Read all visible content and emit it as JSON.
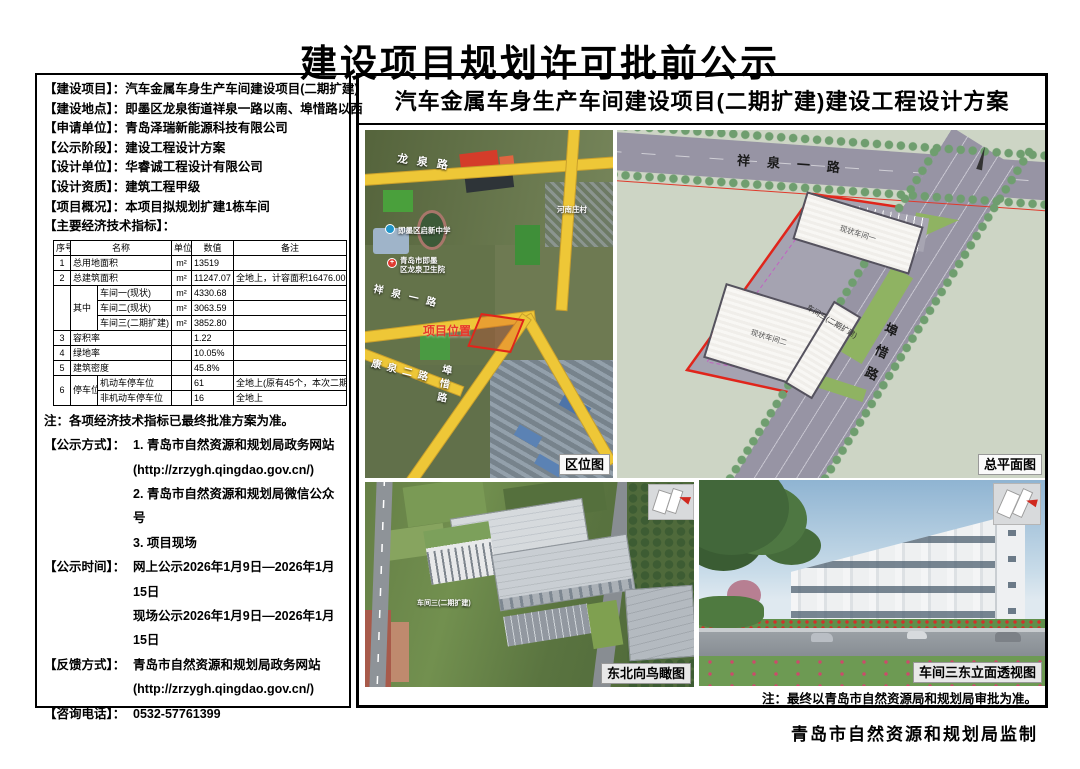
{
  "page": {
    "title": "建设项目规划许可批前公示",
    "footer": "青岛市自然资源和规划局监制"
  },
  "left": {
    "fields": [
      {
        "label": "【建设项目】：",
        "value": "汽车金属车身生产车间建设项目(二期扩建)"
      },
      {
        "label": "【建设地点】：",
        "value": "即墨区龙泉街道祥泉一路以南、埠惜路以西"
      },
      {
        "label": "【申请单位】：",
        "value": "青岛泽瑞新能源科技有限公司"
      },
      {
        "label": "【公示阶段】：",
        "value": "建设工程设计方案"
      },
      {
        "label": "【设计单位】：",
        "value": "华睿诚工程设计有限公司"
      },
      {
        "label": "【设计资质】：",
        "value": "建筑工程甲级"
      },
      {
        "label": "【项目概况】：",
        "value": "本项目拟规划扩建1栋车间"
      },
      {
        "label": "【主要经济技术指标】：",
        "value": ""
      }
    ],
    "table": {
      "header": {
        "seq": "序号",
        "name": "名称",
        "unit": "单位",
        "value": "数值",
        "note": "备注"
      },
      "r1": {
        "seq": "1",
        "name": "总用地面积",
        "unit": "m²",
        "value": "13519",
        "note": ""
      },
      "r2": {
        "seq": "2",
        "name": "总建筑面积",
        "unit": "m²",
        "value": "11247.07",
        "note": "全地上，计容面积16476.00"
      },
      "sub_label": "其中",
      "r2a": {
        "name": "车间一(现状)",
        "unit": "m²",
        "value": "4330.68"
      },
      "r2b": {
        "name": "车间二(现状)",
        "unit": "m²",
        "value": "3063.59"
      },
      "r2c": {
        "name": "车间三(二期扩建)",
        "unit": "m²",
        "value": "3852.80"
      },
      "r3": {
        "seq": "3",
        "name": "容积率",
        "value": "1.22"
      },
      "r4": {
        "seq": "4",
        "name": "绿地率",
        "value": "10.05%"
      },
      "r5": {
        "seq": "5",
        "name": "建筑密度",
        "value": "45.8%"
      },
      "r6_seq": "6",
      "r6_label": "停车位",
      "r6a": {
        "name": "机动车停车位",
        "value": "61",
        "note": "全地上(原有45个，本次二期扩建16个)"
      },
      "r6b": {
        "name": "非机动车停车位",
        "value": "16",
        "note": "全地上"
      }
    },
    "note": "注：各项经济技术指标已最终批准方案为准。",
    "publicity": [
      {
        "label": "【公示方式】：",
        "lines": [
          "1. 青岛市自然资源和规划局政务网站",
          "(http://zrzygh.qingdao.gov.cn/)",
          "2. 青岛市自然资源和规划局微信公众号",
          "3. 项目现场"
        ]
      },
      {
        "label": "【公示时间】：",
        "lines": [
          "网上公示2026年1月9日—2026年1月15日",
          "现场公示2026年1月9日—2026年1月15日"
        ]
      },
      {
        "label": "【反馈方式】：",
        "lines": [
          "青岛市自然资源和规划局政务网站",
          "(http://zrzygh.qingdao.gov.cn/)"
        ]
      },
      {
        "label": "【咨询电话】：",
        "lines": [
          "0532-57761399"
        ]
      }
    ]
  },
  "right": {
    "title": "汽车金属车身生产车间建设项目(二期扩建)建设工程设计方案",
    "approval_note": "注：最终以青岛市自然资源局和规划局审批为准。",
    "location_map": {
      "caption": "区位图",
      "road_longquan": "龙泉路",
      "road_xiangquan": "祥泉一路",
      "road_kangquan": "康泉二路",
      "road_buxi": "埠惜路",
      "project_label": "项目位置",
      "school": "即墨区启新中学",
      "hospital_line1": "青岛市即墨",
      "hospital_line2": "区龙泉卫生院",
      "village": "河南庄村",
      "hospital_cross": "+"
    },
    "site_plan": {
      "caption": "总平面图",
      "road_top": "祥泉一路",
      "road_right": "埠惜路",
      "bldg1": "现状车间一",
      "bldg2": "现状车间二",
      "bldg3": "车间三(二期扩建)"
    },
    "aerial": {
      "caption": "东北向鸟瞰图",
      "bldg3_label": "车间三(二期扩建)"
    },
    "perspective": {
      "caption": "车间三东立面透视图"
    }
  },
  "colors": {
    "boundary_red": "#e0251b",
    "road_yellow": "#eec737",
    "project_red": "#cc2222"
  }
}
